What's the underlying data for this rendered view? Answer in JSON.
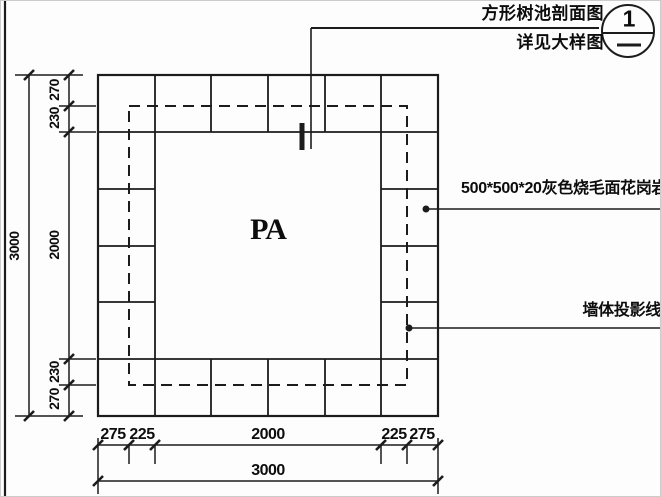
{
  "callout": {
    "title_line1": "方形树池剖面图",
    "title_line2": "详见大样图",
    "bubble_number": "1"
  },
  "labels": {
    "granite": "500*500*20灰色烧毛面花岗岩",
    "wall_projection": "墙体投影线",
    "area_code": "PA"
  },
  "dimensions": {
    "left_total": "3000",
    "left_chain": [
      "270",
      "230",
      "2000",
      "230",
      "270"
    ],
    "bottom_chain": [
      "275",
      "225",
      "2000",
      "225",
      "275"
    ],
    "bottom_total": "3000"
  },
  "colors": {
    "line": "#1c1c1c",
    "text": "#0d0d0d",
    "background": "#fdfdfd"
  }
}
